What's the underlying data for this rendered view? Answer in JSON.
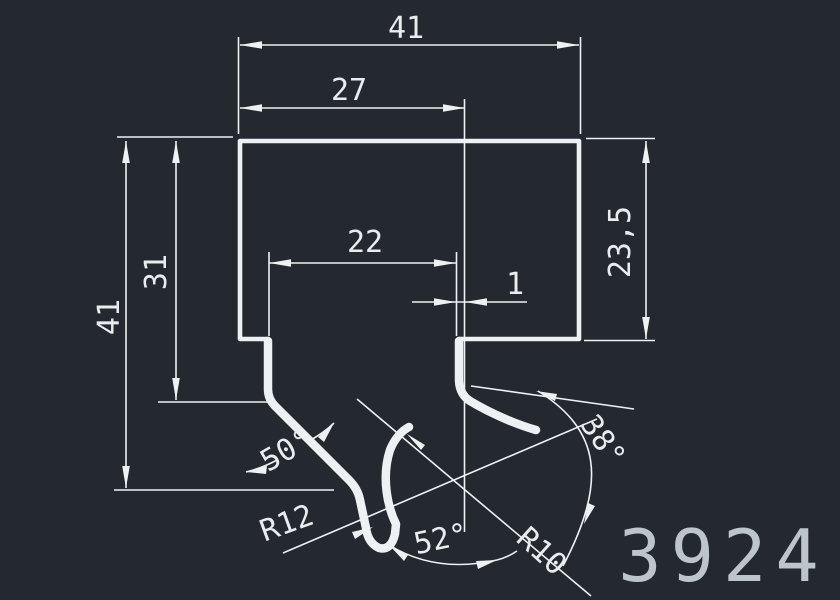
{
  "colors": {
    "background": "#242930",
    "lines": "#eef1f3",
    "dim_text": "#e9edf0",
    "part_number_text": "#bdc4ca"
  },
  "drawing": {
    "part_number": "3924",
    "dimensions": {
      "total_width": "41",
      "top_width": "27",
      "slot_width": "22",
      "wall_offset": "1",
      "right_height": "23,5",
      "left_height": "41",
      "step_height": "31",
      "left_angle": "50°",
      "hairpin_radius": "R12",
      "bottom_angle": "52°",
      "circle_radius": "R10",
      "right_angle": "38°"
    }
  }
}
